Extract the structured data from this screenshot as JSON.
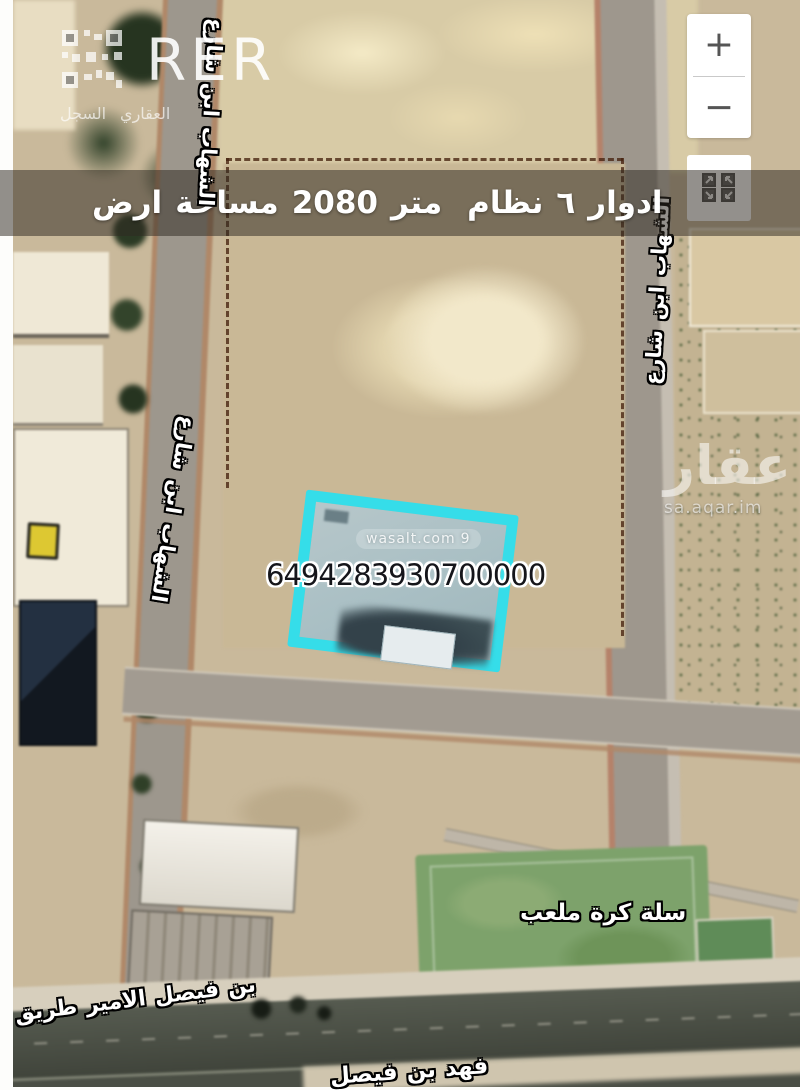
{
  "logo": {
    "brand": "RER",
    "subtitle": "السجل العقاري",
    "subtitle_words": [
      "السجل",
      "العقاري"
    ]
  },
  "map_controls": {
    "zoom_in_label": "+",
    "zoom_out_label": "−"
  },
  "banner": {
    "text": "ارض مساحة 2080 متر نظام ٦ ادوار",
    "words": [
      "ارض",
      "مساحة",
      "2080",
      "متر",
      "نظام",
      "٦",
      "ادوار"
    ]
  },
  "parcel": {
    "number": "6494283930700000",
    "highlight_color": "#35dde9"
  },
  "watermarks": {
    "wasalt_text": "wasalt.com",
    "wasalt_pin_glyph": "9",
    "aqar_logo_text": "عقار",
    "aqar_domain": "sa.aqar.im"
  },
  "street_labels": {
    "ibn_alshahab_top": {
      "text": "شارع ابن الشهاب",
      "words": [
        "شارع",
        "ابن",
        "الشهاب"
      ]
    },
    "ibn_alshahab_left": {
      "text": "شارع ابن الشهاب",
      "words": [
        "شارع",
        "ابن",
        "الشهاب"
      ]
    },
    "ibn_alshahab_right": {
      "text": "شارع ابن الشهاب",
      "words": [
        "شارع",
        "ابن",
        "الشهاب"
      ]
    }
  },
  "place_labels": {
    "basketball_court": {
      "text": "ملعب كرة سلة",
      "words": [
        "ملعب",
        "كرة",
        "سلة"
      ]
    },
    "road_bottom_left": {
      "text": "طريق الامير فيصل بن",
      "words": [
        "طريق",
        "الامير",
        "فيصل",
        "بن"
      ]
    },
    "road_bottom_edge": {
      "text": "فيصل بن فهد",
      "words": [
        "فيصل",
        "بن",
        "فهد"
      ]
    }
  }
}
